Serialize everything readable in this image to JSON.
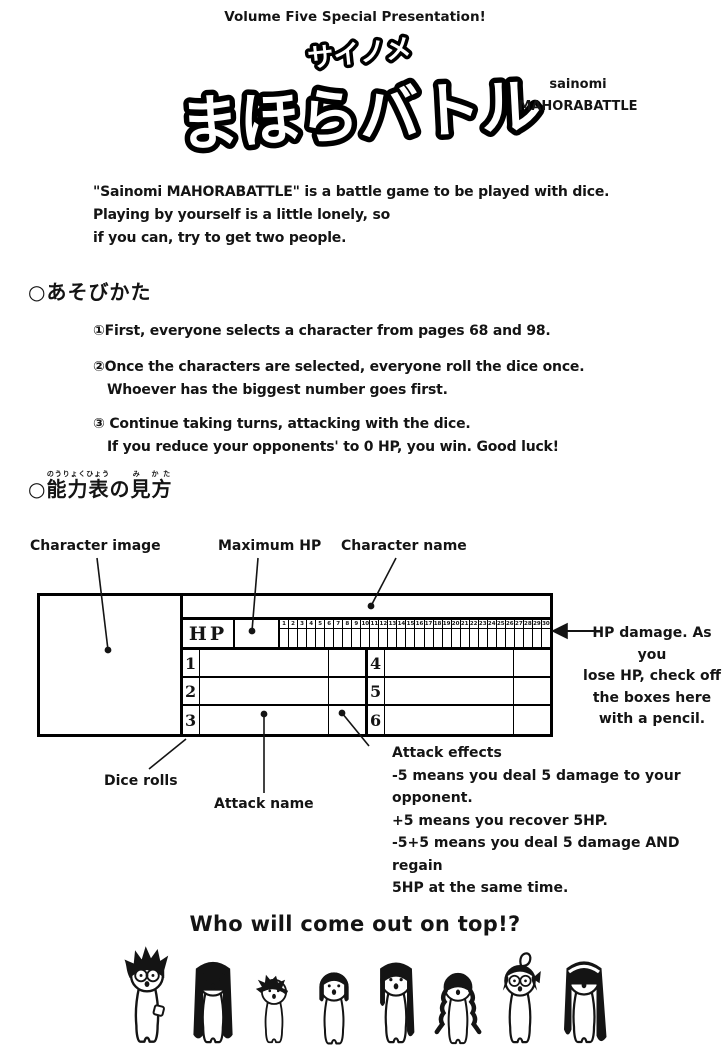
{
  "header": "Volume Five Special Presentation!",
  "logo": {
    "furigana": "サイノメ",
    "main": "まほらバトル",
    "romaji_line1": "sainomi",
    "romaji_line2": "MAHORABATTLE"
  },
  "intro": [
    "\"Sainomi MAHORABATTLE\" is a battle game to be played with dice.",
    "Playing by yourself is a little lonely, so",
    "if you can, try to get two people."
  ],
  "how_to_play": {
    "bullet": "○",
    "heading": "あそびかた",
    "steps": [
      {
        "num": "①",
        "line1": "First, everyone selects a character from pages 68 and 98."
      },
      {
        "num": "②",
        "line1": "Once the characters are selected, everyone roll the dice once.",
        "line2": "Whoever has the biggest number goes first."
      },
      {
        "num": "③ ",
        "line1": "Continue taking turns, attacking with the dice.",
        "line2": "If you reduce your opponents' to 0 HP, you win. Good luck!"
      }
    ]
  },
  "chart_guide": {
    "bullet": "○",
    "heading_kanji1": "能力表",
    "furigana1": "のうりょくひょう",
    "heading_mid": "の",
    "heading_kanji2": "見方",
    "furigana2": "み かた",
    "labels": {
      "character_image": "Character image",
      "maximum_hp": "Maximum HP",
      "character_name": "Character name",
      "hp_damage_lines": [
        "HP damage. As you",
        "lose HP, check off",
        "the boxes here",
        "with a pencil."
      ],
      "dice_rolls": "Dice rolls",
      "attack_name": "Attack name",
      "attack_effects_lines": [
        "Attack effects",
        "-5 means you deal 5 damage to your",
        "opponent.",
        "+5 means you recover 5HP.",
        "-5+5 means you deal 5 damage AND regain",
        "5HP at the same time."
      ]
    },
    "table": {
      "hp_label": "HP",
      "hp_boxes": [
        1,
        2,
        3,
        4,
        5,
        6,
        7,
        8,
        9,
        10,
        11,
        12,
        13,
        14,
        15,
        16,
        17,
        18,
        19,
        20,
        21,
        22,
        23,
        24,
        25,
        26,
        27,
        28,
        29,
        30
      ],
      "dice_numbers": [
        "1",
        "2",
        "3",
        "4",
        "5",
        "6"
      ]
    }
  },
  "footer": {
    "tagline": "Who will come out on top!?",
    "characters": [
      "spiky-hair-boy-with-glasses",
      "girl-long-straight-hair",
      "boy-messy-hair",
      "girl-bob-hair",
      "girl-long-hair-bangs",
      "girl-twin-braids",
      "girl-glasses-ahoge",
      "girl-headband-long-hair"
    ]
  }
}
